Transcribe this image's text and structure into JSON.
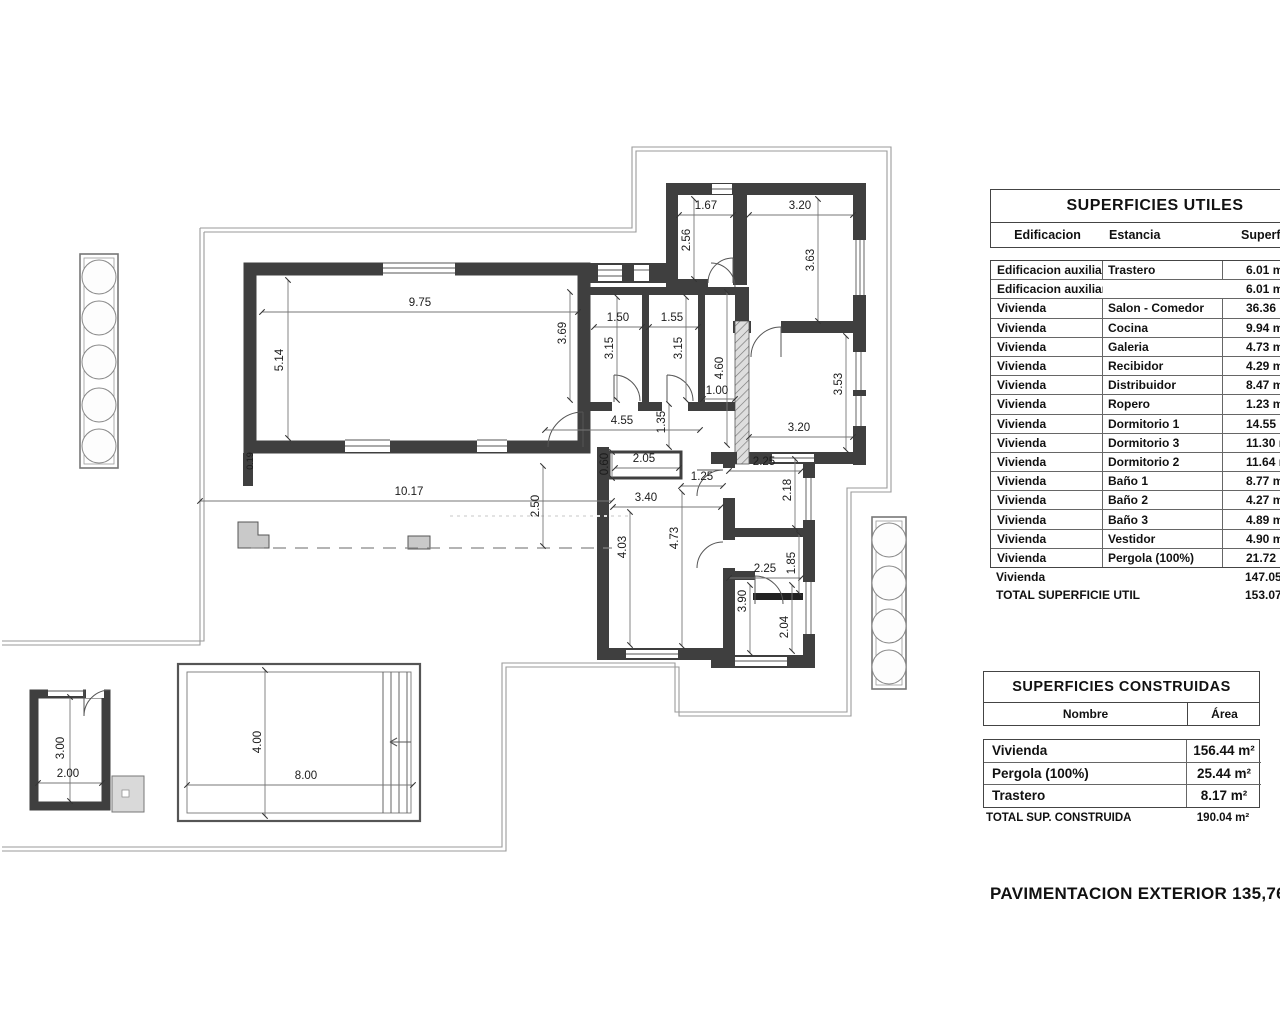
{
  "plan": {
    "dimensions": [
      {
        "t": "9.75",
        "x": 420,
        "y": 306
      },
      {
        "t": "5.14",
        "x": 283,
        "y": 360,
        "v": 1
      },
      {
        "t": "1.67",
        "x": 706,
        "y": 209
      },
      {
        "t": "3.20",
        "x": 800,
        "y": 209
      },
      {
        "t": "2.56",
        "x": 690,
        "y": 240,
        "v": 1
      },
      {
        "t": "3.63",
        "x": 814,
        "y": 260,
        "v": 1
      },
      {
        "t": "1.50",
        "x": 618,
        "y": 321
      },
      {
        "t": "1.55",
        "x": 672,
        "y": 321
      },
      {
        "t": "3.69",
        "x": 566,
        "y": 333,
        "v": 1
      },
      {
        "t": "3.15",
        "x": 613,
        "y": 348,
        "v": 1
      },
      {
        "t": "3.15",
        "x": 682,
        "y": 348,
        "v": 1
      },
      {
        "t": "4.60",
        "x": 723,
        "y": 368,
        "v": 1
      },
      {
        "t": "3.53",
        "x": 842,
        "y": 384,
        "v": 1
      },
      {
        "t": "1.00",
        "x": 717,
        "y": 394
      },
      {
        "t": "4.55",
        "x": 622,
        "y": 424
      },
      {
        "t": "1.35",
        "x": 665,
        "y": 422,
        "v": 1
      },
      {
        "t": "3.20",
        "x": 799,
        "y": 431
      },
      {
        "t": "0.60",
        "x": 608,
        "y": 464,
        "v": 1
      },
      {
        "t": "2.05",
        "x": 644,
        "y": 462
      },
      {
        "t": "1.25",
        "x": 702,
        "y": 480
      },
      {
        "t": "2.25",
        "x": 764,
        "y": 465
      },
      {
        "t": "2.18",
        "x": 791,
        "y": 490,
        "v": 1
      },
      {
        "t": "10.17",
        "x": 409,
        "y": 495
      },
      {
        "t": "2.50",
        "x": 539,
        "y": 506,
        "v": 1
      },
      {
        "t": "3.40",
        "x": 646,
        "y": 501
      },
      {
        "t": "4.03",
        "x": 626,
        "y": 547,
        "v": 1
      },
      {
        "t": "4.73",
        "x": 678,
        "y": 538,
        "v": 1
      },
      {
        "t": "2.25",
        "x": 765,
        "y": 572
      },
      {
        "t": "1.85",
        "x": 795,
        "y": 563,
        "v": 1
      },
      {
        "t": "3.90",
        "x": 746,
        "y": 601,
        "v": 1
      },
      {
        "t": "2.04",
        "x": 788,
        "y": 627,
        "v": 1
      },
      {
        "t": "0.19",
        "x": 253,
        "y": 461,
        "v": 1,
        "s": 1
      },
      {
        "t": "4.00",
        "x": 261,
        "y": 742,
        "v": 1
      },
      {
        "t": "8.00",
        "x": 306,
        "y": 779
      },
      {
        "t": "3.00",
        "x": 64,
        "y": 748,
        "v": 1
      },
      {
        "t": "2.00",
        "x": 68,
        "y": 777
      }
    ]
  },
  "tables": {
    "utiles": {
      "title": "SUPERFICIES UTILES",
      "columns": [
        "Edificacion",
        "Estancia",
        "Superficie"
      ],
      "rows": [
        [
          "Edificacion auxiliar",
          "Trastero",
          "6.01 m²"
        ],
        [
          "Edificacion auxiliar",
          "",
          "6.01 m²"
        ],
        [
          "Vivienda",
          "Salon - Comedor",
          "36.36 m²"
        ],
        [
          "Vivienda",
          "Cocina",
          "9.94 m²"
        ],
        [
          "Vivienda",
          "Galeria",
          "4.73 m²"
        ],
        [
          "Vivienda",
          "Recibidor",
          "4.29 m²"
        ],
        [
          "Vivienda",
          "Distribuidor",
          "8.47 m²"
        ],
        [
          "Vivienda",
          "Ropero",
          "1.23 m²"
        ],
        [
          "Vivienda",
          "Dormitorio 1",
          "14.55 m²"
        ],
        [
          "Vivienda",
          "Dormitorio 3",
          "11.30 m²"
        ],
        [
          "Vivienda",
          "Dormitorio 2",
          "11.64 m²"
        ],
        [
          "Vivienda",
          "Baño 1",
          "8.77 m²"
        ],
        [
          "Vivienda",
          "Baño 2",
          "4.27 m²"
        ],
        [
          "Vivienda",
          "Baño 3",
          "4.89 m²"
        ],
        [
          "Vivienda",
          "Vestidor",
          "4.90 m²"
        ],
        [
          "Vivienda",
          "Pergola  (100%)",
          "21.72 m²"
        ]
      ],
      "subtotal": [
        "Vivienda",
        "147.05 m²"
      ],
      "total": [
        "TOTAL SUPERFICIE UTIL",
        "153.07 m²"
      ]
    },
    "construidas": {
      "title": "SUPERFICIES CONSTRUIDAS",
      "columns": [
        "Nombre",
        "Área"
      ],
      "rows": [
        [
          "Vivienda",
          "156.44 m²"
        ],
        [
          "Pergola  (100%)",
          "25.44 m²"
        ],
        [
          "Trastero",
          "8.17 m²"
        ]
      ],
      "total": [
        "TOTAL SUP. CONSTRUIDA",
        "190.04 m²"
      ]
    }
  },
  "footer": {
    "pavimentacion": "PAVIMENTACION EXTERIOR 135,76 m²"
  }
}
